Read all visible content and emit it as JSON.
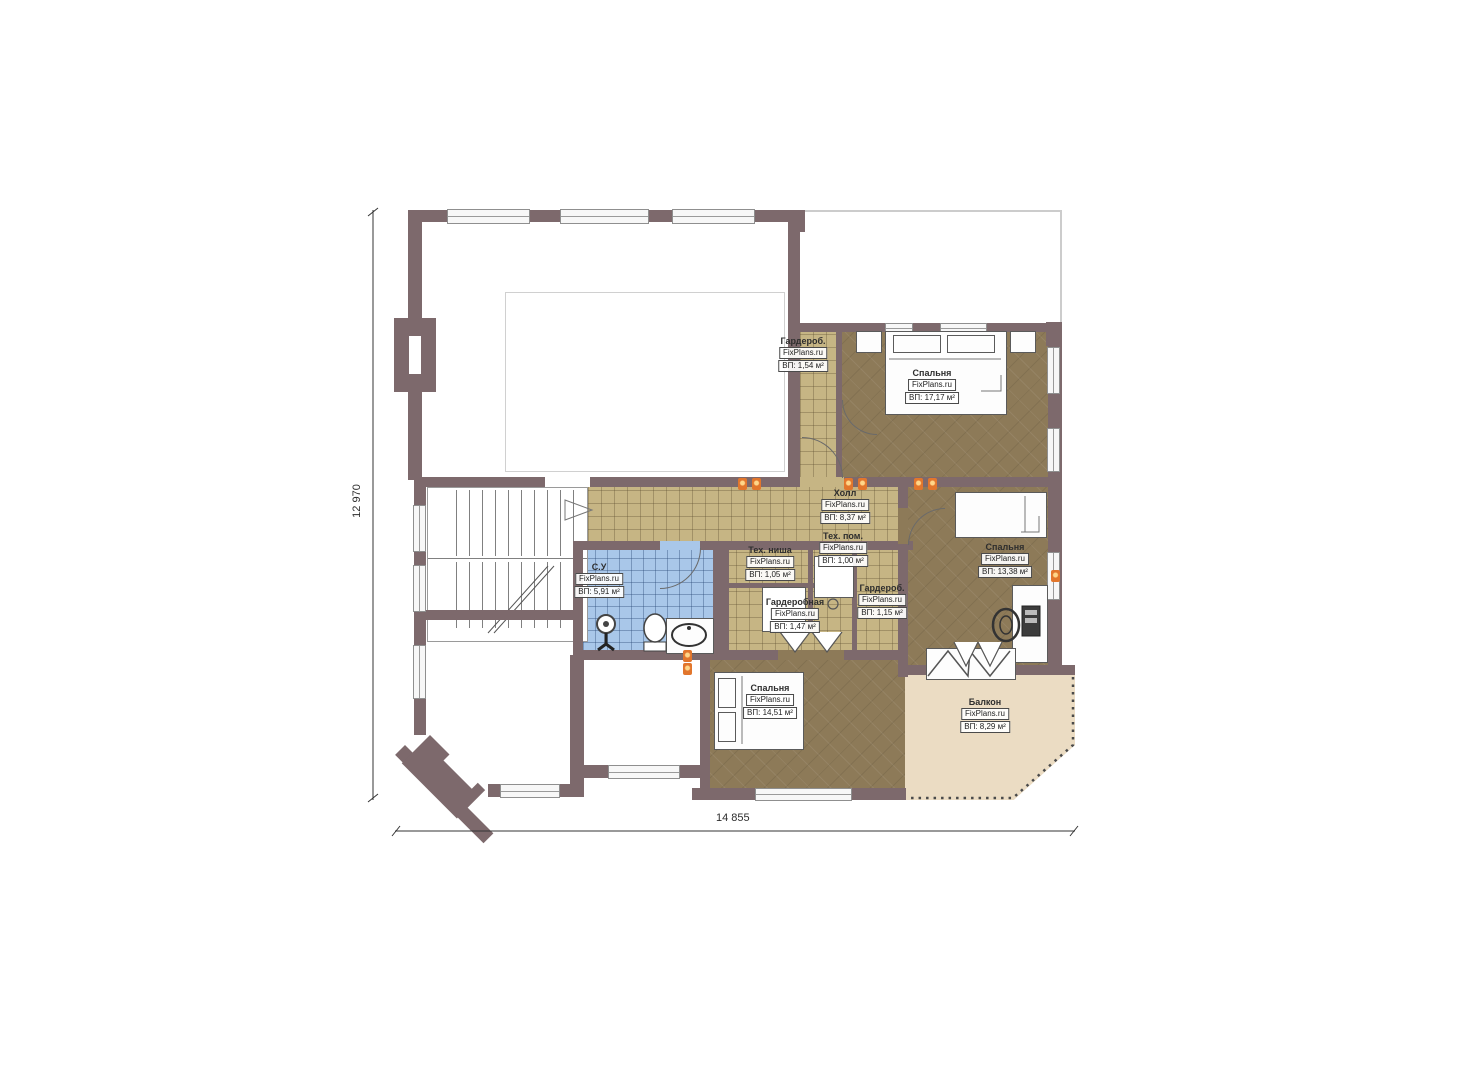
{
  "plan": {
    "watermark": "FixPlans.ru",
    "rooms": [
      {
        "name": "Гардероб.",
        "area": "ВП: 1,54 м²"
      },
      {
        "name": "Спальня",
        "area": "ВП: 17,17 м²"
      },
      {
        "name": "Холл",
        "area": "ВП: 8,37 м²"
      },
      {
        "name": "Тех. ниша",
        "area": "ВП: 1,05 м²"
      },
      {
        "name": "Тех. пом.",
        "area": "ВП: 1,00 м²"
      },
      {
        "name": "Спальня",
        "area": "ВП: 13,38 м²"
      },
      {
        "name": "Гардероб.",
        "area": "ВП: 1,15 м²"
      },
      {
        "name": "С.У",
        "area": "ВП: 5,91 м²"
      },
      {
        "name": "Гардеробная",
        "area": "ВП: 1,47 м²"
      },
      {
        "name": "Спальня",
        "area": "ВП: 14,51 м²"
      },
      {
        "name": "Балкон",
        "area": "ВП: 8,29 м²"
      }
    ],
    "dimensions": {
      "height_mm": "12 970",
      "width_mm": "14 855"
    },
    "colors": {
      "wall": "#7d696c",
      "bedroom_floor": "#8d7a58",
      "tile_floor": "#c6b584",
      "bath_floor": "#a9c7e9",
      "balcony_floor": "#ebdcc3",
      "marker_orange": "#e2762c"
    }
  }
}
